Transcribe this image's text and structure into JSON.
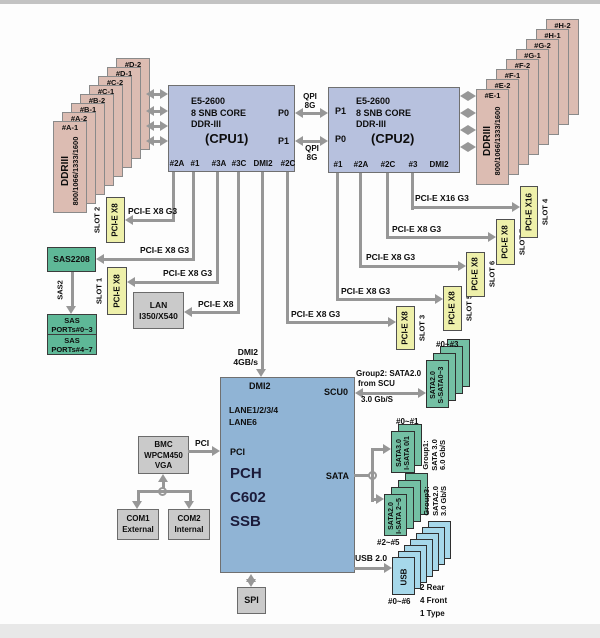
{
  "dimm_left": {
    "front_line1": "DDRIII",
    "front_line2": "800/1066/1333/1600",
    "cards": [
      "#A-1",
      "#A-2",
      "#B-1",
      "#B-2",
      "#C-1",
      "#C-2",
      "#D-1",
      "#D-2"
    ]
  },
  "dimm_right": {
    "front_line1": "DDRIII",
    "front_line2": "800/1066/1333/1600",
    "cards": [
      "#E-1",
      "#E-2",
      "#F-1",
      "#F-2",
      "#G-1",
      "#G-2",
      "#H-1",
      "#H-2"
    ]
  },
  "cpu1": {
    "spec1": "E5-2600",
    "spec2": "8 SNB CORE",
    "spec3": "DDR-III",
    "title": "(CPU1)",
    "p_top": "P0",
    "p_bottom": "P1",
    "ports": [
      "#2A",
      "#1",
      "#3A",
      "#3C",
      "DMI2",
      "#2C"
    ]
  },
  "cpu2": {
    "spec1": "E5-2600",
    "spec2": "8 SNB CORE",
    "spec3": "DDR-III",
    "title": "(CPU2)",
    "p_top": "P1",
    "p_bottom": "P0",
    "ports": [
      "#1",
      "#2A",
      "#2C",
      "#3",
      "DMI2"
    ]
  },
  "qpi": {
    "top_l1": "QPI",
    "top_l2": "8G",
    "bottom_l1": "QPI",
    "bottom_l2": "8G"
  },
  "links": {
    "slot2": "PCI-E X8 G3",
    "sas": "PCI-E X8 G3",
    "slot1": "PCI-E X8 G3",
    "lan": "PCI-E X8",
    "dmi_l1": "DMI2",
    "dmi_l2": "4GB/s",
    "slot3": "PCI-E X8 G3",
    "slot5": "PCI-E X8 G3",
    "slot6": "PCI-E X8 G3",
    "slot7": "PCI-E X8 G3",
    "slot4": "PCI-E X16 G3",
    "pci": "PCI",
    "usb": "USB 2.0",
    "sas2": "SAS2"
  },
  "slots": {
    "slot1": {
      "type": "PCI-E X8",
      "name": "SLOT 1"
    },
    "slot2": {
      "type": "PCI-E X8",
      "name": "SLOT 2"
    },
    "slot3": {
      "type": "PCI-E X8",
      "name": "SLOT 3"
    },
    "slot4": {
      "type": "PCI-E X16",
      "name": "SLOT 4"
    },
    "slot5": {
      "type": "PCI-E X8",
      "name": "SLOT 5"
    },
    "slot6": {
      "type": "PCI-E X8",
      "name": "SLOT 6"
    },
    "slot7": {
      "type": "PCI-E X8",
      "name": "SLOT 7"
    }
  },
  "sas": {
    "controller": "SAS2208",
    "ports_a_l1": "SAS",
    "ports_a_l2": "PORTs#0~3",
    "ports_b_l1": "SAS",
    "ports_b_l2": "PORTs#4~7"
  },
  "lan": {
    "l1": "LAN",
    "l2": "I350/X540"
  },
  "pch": {
    "dmi": "DMI2",
    "scu": "SCU0",
    "lane1": "LANE1/2/3/4",
    "lane2": "LANE6",
    "pci": "PCI",
    "big1": "PCH",
    "big2": "C602",
    "big3": "SSB",
    "sata": "SATA"
  },
  "bmc": {
    "l1": "BMC",
    "l2": "WPCM450",
    "l3": "VGA"
  },
  "com1": {
    "l1": "COM1",
    "l2": "External"
  },
  "com2": {
    "l1": "COM2",
    "l2": "Internal"
  },
  "spi": {
    "label": "SPI"
  },
  "group2": {
    "t1": "Group2: SATA2.0",
    "t2": "from SCU",
    "t3": "3.0 Gb/S",
    "range": "#0~#3",
    "card_l1": "SATA2.0",
    "card_l2": "S-SATA0~3"
  },
  "group1": {
    "range": "#0~#1",
    "card_l1": "SATA3.0",
    "card_l2": "I-SATA 0/1",
    "a1": "Group1:",
    "a2": "SATA 3.0",
    "a3": "6.0 Gb/S"
  },
  "group3": {
    "range": "#2~#5",
    "card_l1": "SATA2.0",
    "card_l2": "I-SATA 2~5",
    "a1": "Group3:",
    "a2": "SATA2.0",
    "a3": "3.0 Gb/S"
  },
  "usb": {
    "range": "#0~#6",
    "card": "USB",
    "note1": "2 Rear",
    "note2": "4 Front",
    "note3": "1 Type"
  },
  "colors": {
    "dimm": "#dcbcb2",
    "cpu": "#b7c1de",
    "pch": "#90b4d5",
    "slot_yellow": "#eef0aa",
    "sas_green": "#5eb897",
    "sata_card_green": "#74c0a4",
    "usb_blue": "#a6d8ea",
    "gray_box": "#cacaca",
    "line_gray": "#979797"
  }
}
